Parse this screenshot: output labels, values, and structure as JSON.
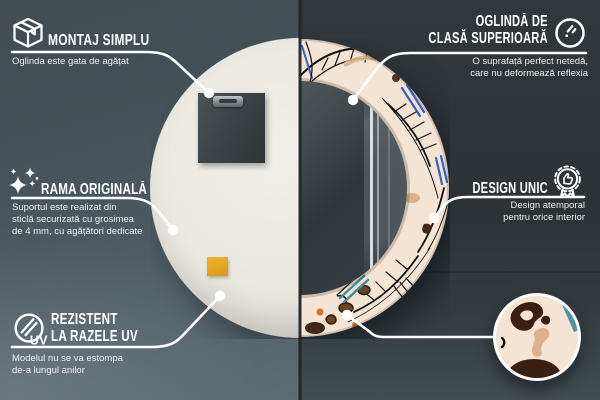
{
  "scene": {
    "description_left_view": "mirror back",
    "description_right_view": "mirror front",
    "colors": {
      "background_left": "#49565c",
      "background_right": "#2e3538",
      "mirror_back": "#eae8e1",
      "pattern_cream": "#f4e4d4",
      "pattern_blue": "#3b5fc5",
      "pattern_teal": "#4f93a3",
      "pattern_brown": "#402718",
      "pattern_orange": "#d2702c",
      "sticker_yellow": "#e2a31f",
      "callout_line": "#ffffff"
    }
  },
  "callouts": [
    {
      "id": "montaj",
      "icon": "package-box-icon",
      "title_lines": [
        "MONTAJ SIMPLU"
      ],
      "subtitle_lines": [
        "Oglinda este gata de agățat"
      ]
    },
    {
      "id": "oglinda",
      "icon": "round-mirror-icon",
      "title_lines": [
        "OGLINDĂ DE",
        "CLASĂ SUPERIOARĂ"
      ],
      "subtitle_lines": [
        "O suprafață perfect netedă,",
        "care nu deformează reflexia"
      ]
    },
    {
      "id": "rama",
      "icon": "sparkles-icon",
      "title_lines": [
        "RAMA ORIGINALĂ"
      ],
      "subtitle_lines": [
        "Suportul este realizat din",
        "sticlă securizată cu grosimea",
        "de 4 mm, cu agățători dedicate"
      ]
    },
    {
      "id": "design",
      "icon": "award-badge-icon",
      "title_lines": [
        "DESIGN UNIC"
      ],
      "subtitle_lines": [
        "Design atemporal",
        "pentru orice interior"
      ]
    },
    {
      "id": "uv",
      "icon": "uv-lens-icon",
      "icon_label": "UV",
      "title_lines": [
        "REZISTENT",
        "LA RAZELE UV"
      ],
      "subtitle_lines": [
        "Modelul nu se va estompa",
        "de-a lungul anilor"
      ]
    }
  ]
}
